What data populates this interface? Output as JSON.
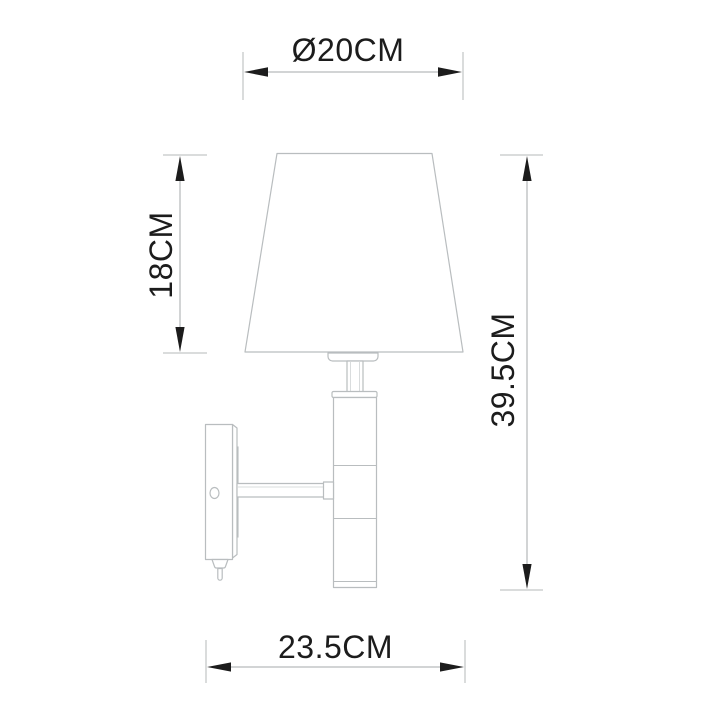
{
  "canvas_bg": "#ffffff",
  "colors": {
    "outline": "#b9bdbf",
    "outline_light": "#d9dcdd",
    "bracket_fill": "#ececec",
    "dim_line": "#a6a9ab",
    "ext_line": "#b4b8ba",
    "arrow": "#1c1c1c",
    "text": "#1c1c1c",
    "fill": "#ffffff"
  },
  "labels": {
    "diameter": "Ø20CM",
    "shade_height": "18CM",
    "total_height": "39.5CM",
    "depth": "23.5CM"
  }
}
